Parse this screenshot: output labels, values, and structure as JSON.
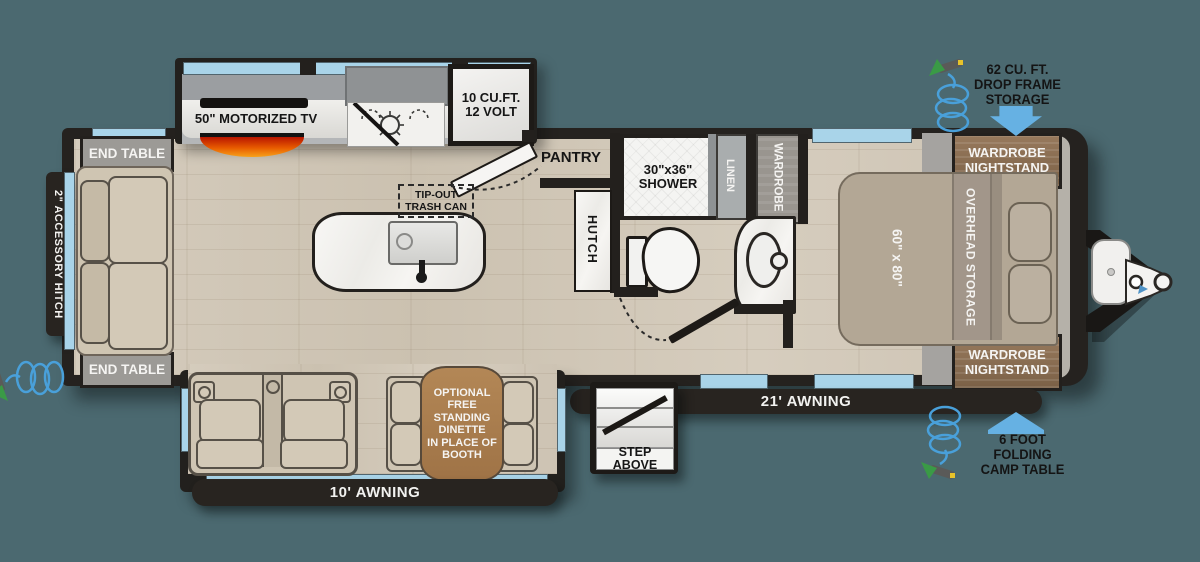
{
  "colors": {
    "background": "#4b6970",
    "wall": "#23201d",
    "window": "#a9d4e9",
    "arrow_blue": "#66b1e3",
    "booth_table": "#aa7f51",
    "bed": "#b3a795"
  },
  "exterior": {
    "hitch_label": "2\" ACCESSORY HITCH",
    "storage_note": {
      "l1": "62 CU. FT.",
      "l2": "DROP FRAME",
      "l3": "STORAGE"
    },
    "camp_table_note": {
      "l1": "6 FOOT",
      "l2": "FOLDING",
      "l3": "CAMP TABLE"
    },
    "awning_main": "21' AWNING",
    "awning_rear": "10' AWNING",
    "step": "STEP ABOVE"
  },
  "living": {
    "end_table_top": "END TABLE",
    "end_table_bottom": "END TABLE",
    "tv": "50\" MOTORIZED TV",
    "trash": {
      "l1": "TIP-OUT",
      "l2": "TRASH CAN"
    },
    "dinette": {
      "l1": "OPTIONAL",
      "l2": "FREE",
      "l3": "STANDING",
      "l4": "DINETTE",
      "l5": "IN PLACE OF",
      "l6": "BOOTH"
    }
  },
  "kitchen": {
    "fridge": {
      "l1": "10 CU.FT.",
      "l2": "12 VOLT"
    },
    "pantry": "PANTRY",
    "hutch": "HUTCH"
  },
  "bath": {
    "shower": {
      "l1": "30\"x36\"",
      "l2": "SHOWER"
    },
    "linen": "LINEN",
    "wardrobe": "WARDROBE"
  },
  "bedroom": {
    "nightstand_top": {
      "l1": "WARDROBE",
      "l2": "NIGHTSTAND"
    },
    "nightstand_bottom": {
      "l1": "WARDROBE",
      "l2": "NIGHTSTAND"
    },
    "bed_size": "60\" x 80\"",
    "overhead": "OVERHEAD STORAGE"
  }
}
